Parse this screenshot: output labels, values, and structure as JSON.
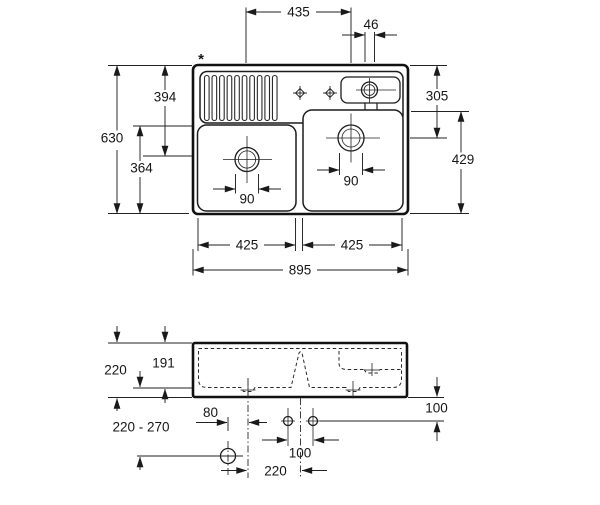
{
  "drawing": {
    "title_hidden": "double bowl sink installation drawing",
    "line_color": "#1a1a1a",
    "background": "#ffffff",
    "footnote_marker": "*",
    "top_view": {
      "labels": {
        "between_drains": "435",
        "channel_width": "46",
        "total_depth": "630",
        "back_to_left_drain": "394",
        "front_to_left_bowl": "364",
        "back_to_right_drain": "305",
        "right_bowl_depth": "429",
        "left_drain_diameter": "90",
        "right_drain_diameter": "90",
        "left_bowl_width": "425",
        "right_bowl_width": "425",
        "total_width": "895"
      }
    },
    "front_view": {
      "labels": {
        "total_height": "220",
        "bowl_inner_depth": "191",
        "outlet_height_range": "220 - 270",
        "outlet_offset": "80",
        "tap_hole_spacing": "100",
        "tap_hole_setback": "100",
        "drain_to_centerline": "220"
      }
    }
  }
}
